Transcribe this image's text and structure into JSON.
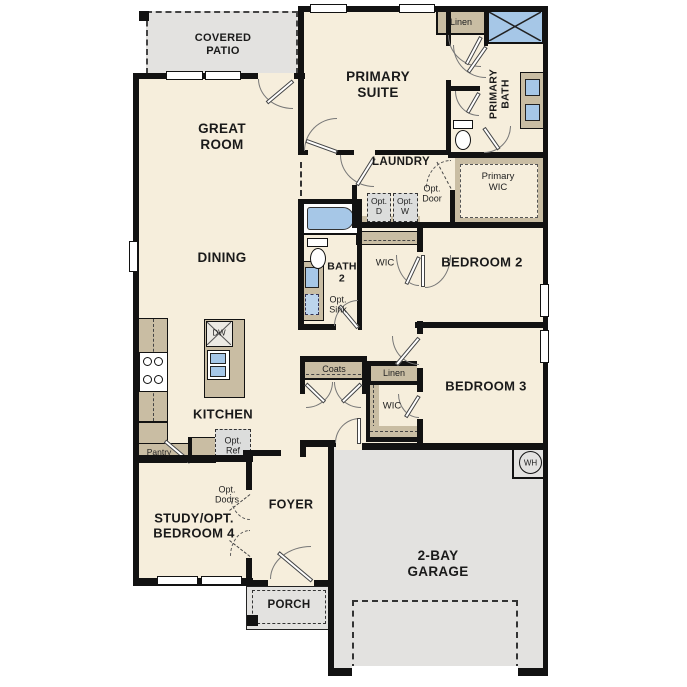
{
  "palette": {
    "floor": "#f6eedc",
    "wall": "#121212",
    "cabinet_tan": "#c9bda3",
    "concrete_gray": "#e3e2e0",
    "option_gray": "#dcdddc",
    "fixture_blue": "#a6c7e7"
  },
  "rooms": {
    "covered_patio": {
      "label": "COVERED\nPATIO"
    },
    "great_room": {
      "label": "GREAT\nROOM"
    },
    "primary_suite": {
      "label": "PRIMARY\nSUITE"
    },
    "linen_top": {
      "label": "Linen"
    },
    "primary_bath": {
      "label": "PRIMARY\nBATH"
    },
    "primary_wic": {
      "label": "Primary\nWIC"
    },
    "laundry": {
      "label": "LAUNDRY"
    },
    "opt_door": {
      "label": "Opt.\nDoor"
    },
    "opt_dryer": {
      "label": "Opt.\nD"
    },
    "opt_washer": {
      "label": "Opt.\nW"
    },
    "dining": {
      "label": "DINING"
    },
    "bath_2": {
      "label": "BATH\n2"
    },
    "opt_sink": {
      "label": "Opt.\nSink"
    },
    "wic_bed2": {
      "label": "WIC"
    },
    "bedroom_2": {
      "label": "BEDROOM 2"
    },
    "bedroom_3": {
      "label": "BEDROOM 3"
    },
    "kitchen": {
      "label": "KITCHEN"
    },
    "dishwasher": {
      "label": "DW"
    },
    "coats": {
      "label": "Coats"
    },
    "linen_hall": {
      "label": "Linen"
    },
    "wic_bed3": {
      "label": "WIC"
    },
    "pantry": {
      "label": "Pantry"
    },
    "opt_ref": {
      "label": "Opt.\nRef"
    },
    "opt_doors": {
      "label": "Opt.\nDoors"
    },
    "study": {
      "label": "STUDY/OPT.\nBEDROOM 4"
    },
    "foyer": {
      "label": "FOYER"
    },
    "porch": {
      "label": "PORCH"
    },
    "garage": {
      "label": "2-BAY\nGARAGE"
    },
    "water_heater": {
      "label": "WH"
    }
  }
}
